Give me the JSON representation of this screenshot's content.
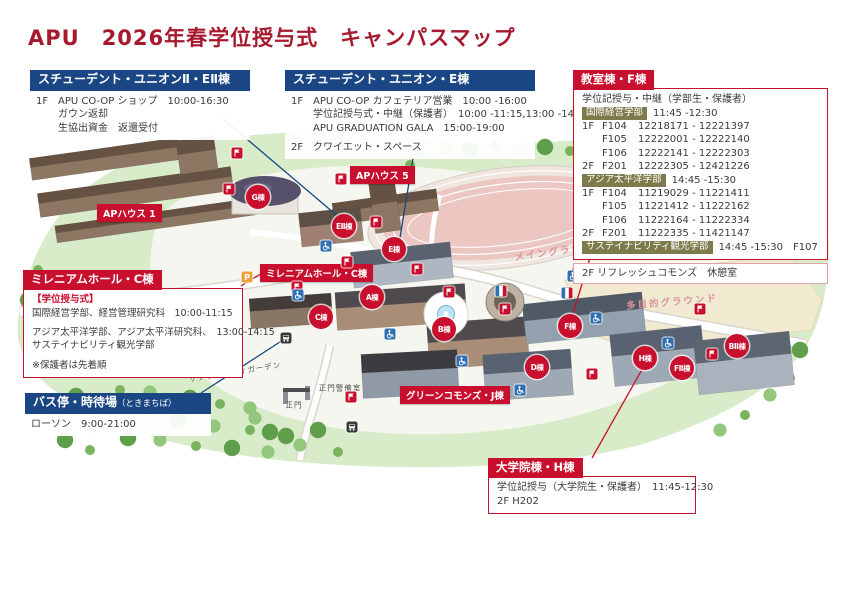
{
  "title": "APU　2026年春学位授与式　キャンパスマップ",
  "colors": {
    "header_blue": "#1A4784",
    "accent_red": "#C8102E",
    "dept_chip_olive": "#7D7B4B",
    "title_red": "#A6192E",
    "ground_label_pink": "#D9959B"
  },
  "boxes": {
    "union2": {
      "header": "スチューデント・ユニオンⅡ・EⅡ棟",
      "lines": [
        {
          "floor": "1F",
          "text": "APU CO-OP ショップ　10:00-16:30"
        },
        {
          "indent": true,
          "text": "ガウン返却"
        },
        {
          "indent": true,
          "text": "生協出資金　返還受付"
        }
      ]
    },
    "union_e": {
      "header": "スチューデント・ユニオン・E棟",
      "lines": [
        {
          "floor": "1F",
          "text": "APU CO-OP カフェテリア営業　10:00 -16:00"
        },
        {
          "indent": true,
          "text": "学位記授与式・中継（保護者）　10:00 -11:15,13:00 -14:15"
        },
        {
          "indent": true,
          "text": "APU GRADUATION GALA　15:00-19:00"
        },
        {
          "floor": "2F",
          "text": "クワイエット・スペース",
          "gap": true
        }
      ]
    },
    "classroom_f": {
      "header": "教室棟・F棟",
      "lines": [
        {
          "text": "学位記授与・中継（学部生・保護者）"
        },
        {
          "kind": "chip",
          "chip": "国際経営学部",
          "text": "11:45 -12:30"
        },
        {
          "kind": "room",
          "floor": "1F",
          "room": "F104",
          "range": "12218171 - 12221397"
        },
        {
          "kind": "room",
          "floor": "",
          "room": "F105",
          "range": "12222001 - 12222140"
        },
        {
          "kind": "room",
          "floor": "",
          "room": "F106",
          "range": "12222141 - 12222303"
        },
        {
          "kind": "room",
          "floor": "2F",
          "room": "F201",
          "range": "12222305 - 12421226"
        },
        {
          "kind": "chip",
          "chip": "アジア太平洋学部",
          "text": "14:45 -15:30"
        },
        {
          "kind": "room",
          "floor": "1F",
          "room": "F104",
          "range": "11219029 - 11221411"
        },
        {
          "kind": "room",
          "floor": "",
          "room": "F105",
          "range": "11221412 - 11222162"
        },
        {
          "kind": "room",
          "floor": "",
          "room": "F106",
          "range": "11222164 - 11222334"
        },
        {
          "kind": "room",
          "floor": "2F",
          "room": "F201",
          "range": "11222335 - 11421147"
        },
        {
          "kind": "chip",
          "chip": "サステイナビリティ観光学部",
          "text": "14:45 -15:30　F107"
        }
      ],
      "note": "2F リフレッシュコモンズ　休憩室"
    },
    "millennium": {
      "header": "ミレニアムホール・C棟",
      "lines": [
        {
          "kind": "red",
          "text": "【学位授与式】"
        },
        {
          "text": "国際経営学部、経営管理研究科　10:00-11:15"
        },
        {
          "text": "アジア太平洋学部、アジア太平洋研究科、　13:00-14:15",
          "gap": true
        },
        {
          "text": "サステイナビリティ観光学部"
        },
        {
          "text": "※保護者は先着順",
          "gap": true
        }
      ]
    },
    "bus_stop": {
      "header": "バス停・時待場",
      "header_small": "（ときまちば）",
      "lines": [
        {
          "text": "ローソン　9:00-21:00"
        }
      ]
    },
    "graduate_h": {
      "header": "大学院棟・H棟",
      "lines": [
        {
          "text": "学位記授与（大学院生・保護者）　11:45-12:30"
        },
        {
          "text": "2F H202"
        }
      ]
    }
  },
  "map": {
    "plates": [
      {
        "text": "APハウス 1",
        "x": 97,
        "y": 204
      },
      {
        "text": "APハウス 5",
        "x": 350,
        "y": 166
      },
      {
        "text": "ミレニアムホール・C棟",
        "x": 260,
        "y": 264
      },
      {
        "text": "グリーンコモンズ・J棟",
        "x": 400,
        "y": 386
      }
    ],
    "circles": [
      {
        "text": "G棟",
        "x": 258,
        "y": 197
      },
      {
        "text": "EⅡ棟",
        "x": 344,
        "y": 226
      },
      {
        "text": "E棟",
        "x": 394,
        "y": 249
      },
      {
        "text": "C棟",
        "x": 321,
        "y": 317
      },
      {
        "text": "A棟",
        "x": 372,
        "y": 297
      },
      {
        "text": "B棟",
        "x": 444,
        "y": 329
      },
      {
        "text": "D棟",
        "x": 537,
        "y": 367
      },
      {
        "text": "F棟",
        "x": 570,
        "y": 326
      },
      {
        "text": "H棟",
        "x": 645,
        "y": 358
      },
      {
        "text": "FⅡ棟",
        "x": 682,
        "y": 368
      },
      {
        "text": "BⅡ棟",
        "x": 737,
        "y": 346
      }
    ],
    "area_labels": [
      {
        "text": "メイングラウンド",
        "x": 560,
        "y": 250,
        "rot": -8
      },
      {
        "text": "多目的グラウンド",
        "x": 672,
        "y": 301,
        "rot": -5
      }
    ],
    "small_labels": [
      {
        "text": "サクラ・スウィガーデン",
        "x": 235,
        "y": 372,
        "rot": -9
      },
      {
        "text": "正門警備室",
        "x": 340,
        "y": 388,
        "rot": 0
      },
      {
        "text": "正門",
        "x": 294,
        "y": 405,
        "rot": 0
      }
    ],
    "icons": {
      "apu_flag": [
        [
          237,
          153
        ],
        [
          229,
          189
        ],
        [
          341,
          179
        ],
        [
          376,
          222
        ],
        [
          297,
          287
        ],
        [
          347,
          262
        ],
        [
          417,
          269
        ],
        [
          449,
          292
        ],
        [
          578,
          272
        ],
        [
          505,
          309
        ],
        [
          592,
          374
        ],
        [
          700,
          309
        ],
        [
          712,
          354
        ],
        [
          351,
          397
        ]
      ],
      "accessibility": [
        [
          298,
          295
        ],
        [
          326,
          246
        ],
        [
          390,
          334
        ],
        [
          462,
          361
        ],
        [
          520,
          390
        ],
        [
          596,
          318
        ],
        [
          668,
          343
        ],
        [
          573,
          276
        ],
        [
          236,
          298
        ]
      ],
      "parking": [
        [
          247,
          277
        ]
      ],
      "bus": [
        [
          286,
          338
        ],
        [
          352,
          427
        ]
      ],
      "info_flag": [
        [
          501,
          291
        ],
        [
          567,
          293
        ]
      ]
    }
  }
}
